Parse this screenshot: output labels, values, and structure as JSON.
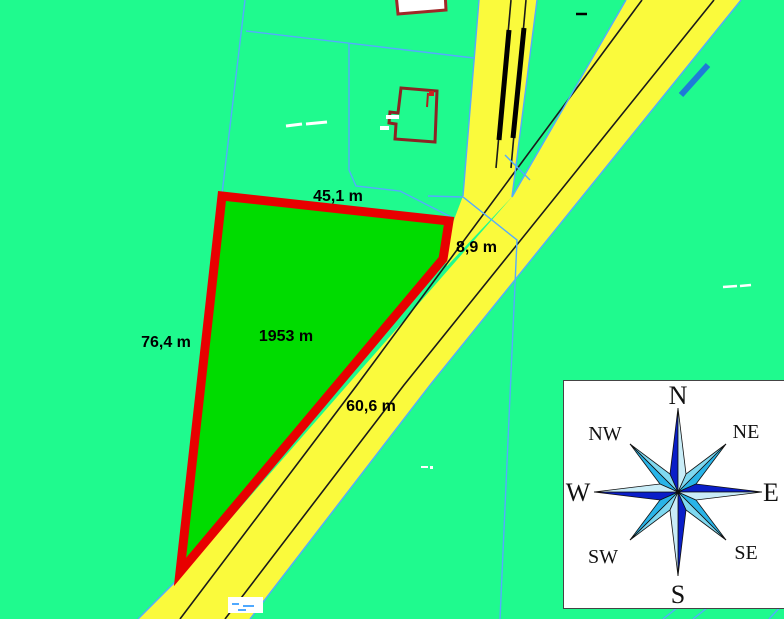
{
  "map": {
    "measurements": {
      "top_edge": "45,1 m",
      "right_edge": "8,9 m",
      "left_edge": "76,4 m",
      "area": "1953 m",
      "road_edge": "60,6 m"
    },
    "colors": {
      "background": "#1FFA8E",
      "parcel_fill": "#00DC00",
      "parcel_border": "#E80000",
      "road_fill": "#FAFA3C",
      "cadastral_line": "#55AAFF",
      "road_marking": "#1A1A1A",
      "building_outline": "#8B2424",
      "water_mark": "#1E7AD8"
    }
  },
  "compass": {
    "labels": {
      "n": "N",
      "ne": "NE",
      "e": "E",
      "se": "SE",
      "s": "S",
      "sw": "SW",
      "w": "W",
      "nw": "NW"
    },
    "colors": {
      "dark": "#0A1EC8",
      "medium": "#29B4E8",
      "light": "#7FD8F0",
      "pale": "#C9EDF8"
    }
  }
}
